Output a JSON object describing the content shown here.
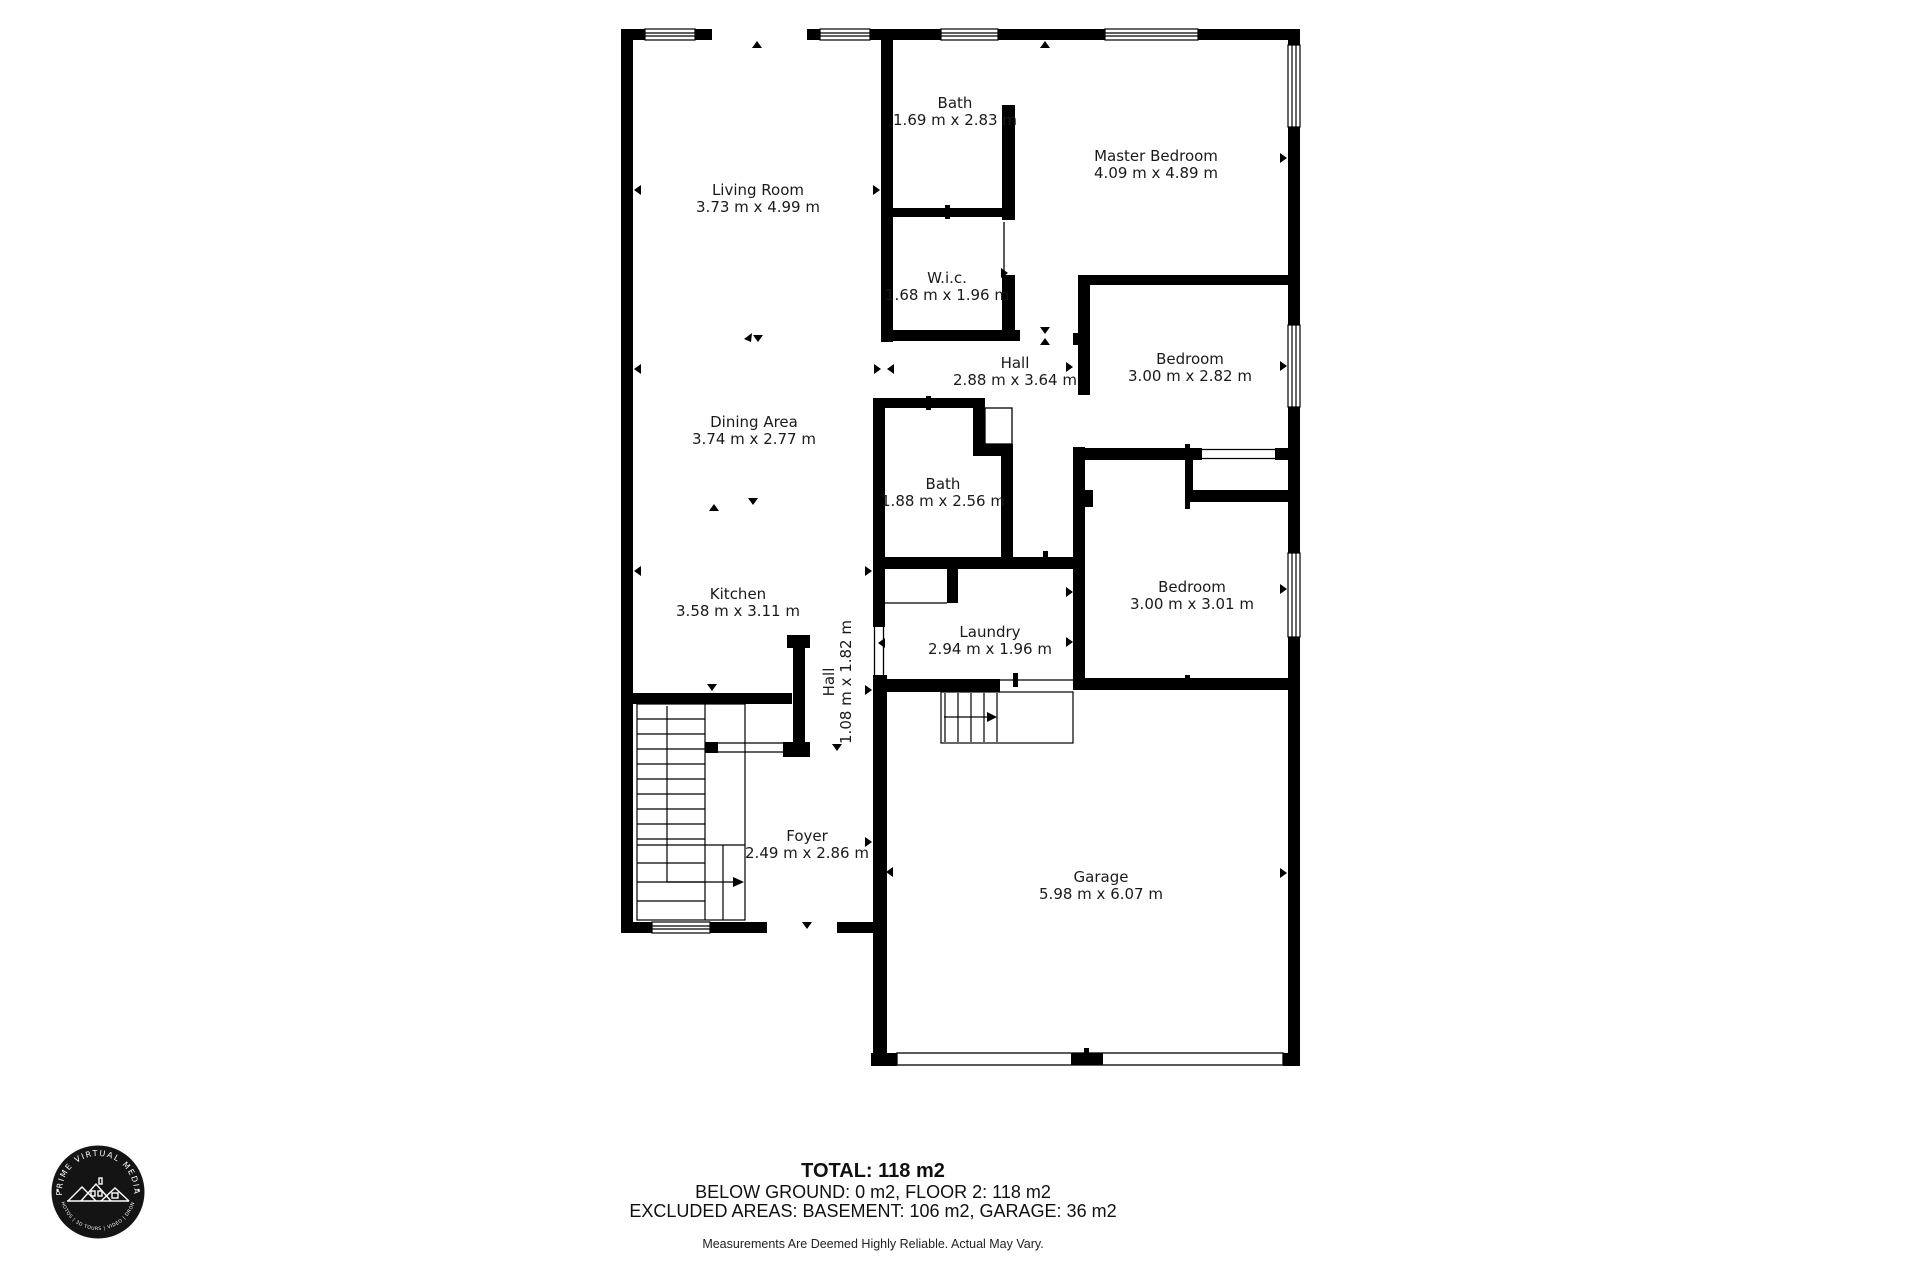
{
  "plan": {
    "rooms": [
      {
        "name": "Living Room",
        "dims": "3.73 m x 4.99 m"
      },
      {
        "name": "Bath",
        "dims": "1.69 m x 2.83 m"
      },
      {
        "name": "Master Bedroom",
        "dims": "4.09 m x 4.89 m"
      },
      {
        "name": "W.i.c.",
        "dims": "1.68 m x 1.96 m"
      },
      {
        "name": "Hall",
        "dims": "2.88 m x 3.64 m"
      },
      {
        "name": "Bedroom",
        "dims": "3.00 m x 2.82 m"
      },
      {
        "name": "Dining Area",
        "dims": "3.74 m x 2.77 m"
      },
      {
        "name": "Bath",
        "dims": "1.88 m x 2.56 m"
      },
      {
        "name": "Bedroom",
        "dims": "3.00 m x 3.01 m"
      },
      {
        "name": "Kitchen",
        "dims": "3.58 m x 3.11 m"
      },
      {
        "name": "Laundry",
        "dims": "2.94 m x 1.96 m"
      },
      {
        "name": "Hall",
        "dims": "1.08 m x 1.82 m"
      },
      {
        "name": "Foyer",
        "dims": "2.49 m x 2.86 m"
      },
      {
        "name": "Garage",
        "dims": "5.98 m x 6.07 m"
      }
    ]
  },
  "summary": {
    "total": "TOTAL: 118 m2",
    "line2": "BELOW GROUND: 0 m2, FLOOR 2: 118 m2",
    "line3": "EXCLUDED AREAS: BASEMENT: 106 m2, GARAGE: 36 m2",
    "disclaimer": "Measurements Are Deemed Highly Reliable. Actual May Vary."
  },
  "logo": {
    "arc_top": "PRIME VIRTUAL MEDIA",
    "arc_bottom": "PHOTOS | 3D TOURS | VIDEO | DRONE"
  },
  "colors": {
    "wall": "#000000",
    "background": "#ffffff",
    "text": "#1a1a1a",
    "logo_bg": "#141414"
  }
}
